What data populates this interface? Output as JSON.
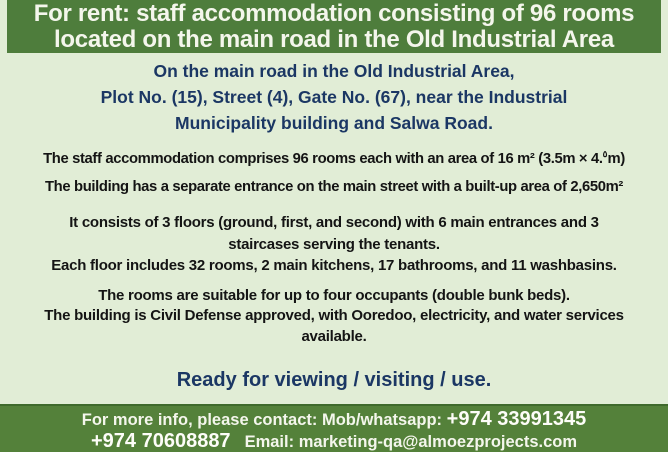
{
  "colors": {
    "page_bg": "#e1edd6",
    "header_bg": "#4e7d3c",
    "footer_bg": "#54813a",
    "footer_border": "#3f6a2c",
    "navy_text": "#1b3764",
    "black_text": "#141414",
    "white_text": "#f4f6ec"
  },
  "header": {
    "lines": [
      "For rent: staff accommodation consisting of 96 rooms",
      "located on the main road in the Old Industrial Area"
    ]
  },
  "location": {
    "lines": [
      "On the main road in the Old Industrial Area,",
      "Plot No. (15), Street (4), Gate No. (67), near the Industrial",
      "Municipality building and Salwa Road."
    ]
  },
  "specs": {
    "area": {
      "pre": "The staff accommodation comprises 96 rooms each with an area of 16 m² (3.5m × 4.",
      "sup": "٥",
      "post": "m)"
    },
    "entrance": "The building has a separate entrance on the main street with a built-up area of 2,650m²"
  },
  "floors": {
    "lines": [
      "It consists of 3 floors (ground, first, and second) with 6 main entrances and 3",
      "staircases serving the tenants.",
      "Each floor includes 32 rooms, 2 main kitchens, 17 bathrooms, and 11 washbasins."
    ]
  },
  "occupancy": {
    "lines": [
      "The rooms are suitable for up to four occupants (double bunk beds).",
      "The building is Civil Defense approved, with Ooredoo, electricity, and water services",
      "available."
    ]
  },
  "ready_line": "Ready for viewing / visiting / use.",
  "footer": {
    "intro": "For more info, please contact: Mob/whatsapp:",
    "phone1": "+974 33991345",
    "phone2": "+974 70608887",
    "email_label": "Email:",
    "email": "marketing-qa@almoezprojects.com"
  }
}
